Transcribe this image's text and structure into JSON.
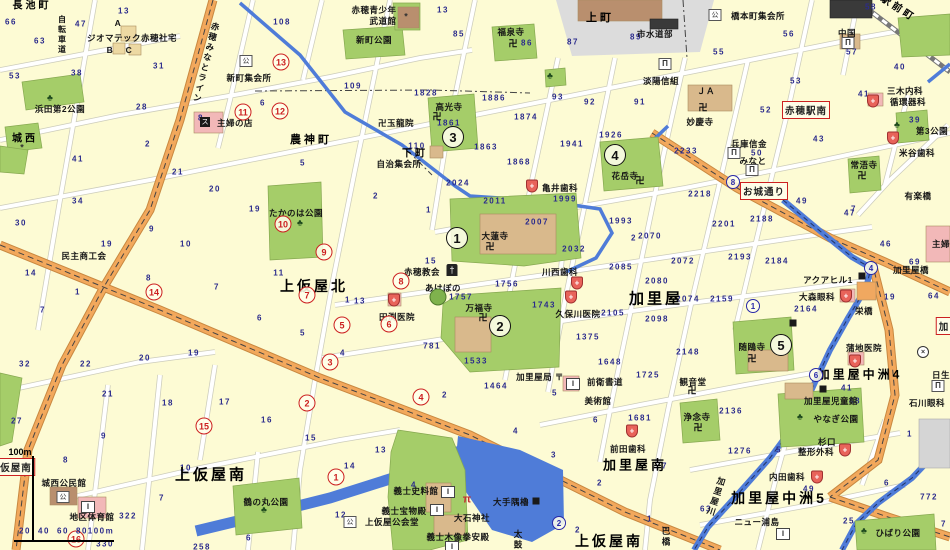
{
  "palette": {
    "background": "#FDFBD4",
    "road": "#FFFFFF",
    "road_casing": "#CCCCBB",
    "main_road": "#F2A85C",
    "water": "#4F7CD8",
    "park": "#A5CD69",
    "building_tan": "#D9B98C",
    "building_brown": "#B98F6E",
    "building_pink": "#F2B8B8",
    "building_gray": "#D5D5D5",
    "building_dark": "#3A3A3A",
    "number_text": "#2B2B8C",
    "red_mark": "#CC2020",
    "blue_mark": "#2828A8"
  },
  "scale": {
    "top_label": "100m",
    "tick_labels": [
      "20",
      "40",
      "60",
      "80",
      "100m"
    ]
  },
  "areas": [
    [
      "長池町",
      32,
      4,
      10,
      0
    ],
    [
      "上町",
      600,
      17,
      11,
      0
    ],
    [
      "駅前町",
      899,
      7,
      10,
      33
    ],
    [
      "農神町",
      311,
      139,
      11,
      0
    ],
    [
      "下町",
      415,
      152,
      10,
      0
    ],
    [
      "城西",
      25,
      137,
      10,
      0
    ],
    [
      "上仮屋北",
      314,
      286,
      14,
      0
    ],
    [
      "加里屋",
      656,
      298,
      15,
      0
    ],
    [
      "上仮屋南",
      211,
      474,
      15,
      0
    ],
    [
      "加里屋南",
      635,
      464,
      13,
      0
    ],
    [
      "上仮屋南",
      609,
      541,
      14,
      0
    ],
    [
      "加里屋中洲4",
      860,
      374,
      12,
      0
    ],
    [
      "加里屋中洲5",
      779,
      498,
      14,
      0
    ]
  ],
  "vlabels": [
    [
      "自転車道",
      62,
      35,
      8,
      0
    ],
    [
      "赤穂みなとライン",
      206,
      63,
      8.5,
      14
    ],
    [
      "加里屋川",
      716,
      497,
      8.5,
      18
    ],
    [
      "巴橋",
      666,
      537,
      8.5,
      0
    ],
    [
      "太鼓",
      518,
      540,
      8.5,
      0
    ]
  ],
  "places": [
    [
      "ジオマテック赤穂社宅",
      132,
      38
    ],
    [
      "A",
      118,
      23
    ],
    [
      "B",
      110,
      50
    ],
    [
      "C",
      129,
      50
    ],
    [
      "新町集会所",
      249,
      78
    ],
    [
      "主婦の店",
      235,
      123
    ],
    [
      "浜田第2公園",
      60,
      109
    ],
    [
      "赤穂青少年",
      374,
      10
    ],
    [
      "武道館",
      383,
      21
    ],
    [
      "新町公園",
      374,
      40
    ],
    [
      "福泉寺",
      511,
      32
    ],
    [
      "卍玉龍院",
      396,
      123
    ],
    [
      "高光寺",
      449,
      107
    ],
    [
      "自治集会所",
      399,
      164
    ],
    [
      "淡陽信組",
      661,
      81
    ],
    [
      "市水道部",
      655,
      34
    ],
    [
      "橋本町集会所",
      758,
      16
    ],
    [
      "中国",
      847,
      33
    ],
    [
      "妙慶寺",
      700,
      122
    ],
    [
      "ＪＡ",
      706,
      91
    ],
    [
      "兵庫信金",
      749,
      144
    ],
    [
      "みなと",
      753,
      161
    ],
    [
      "三木内科",
      905,
      91
    ],
    [
      "循環器科",
      908,
      102
    ],
    [
      "米谷歯科",
      917,
      153
    ],
    [
      "第3公園",
      932,
      131
    ],
    [
      "常浯寺",
      864,
      165
    ],
    [
      "有楽橋",
      918,
      196
    ],
    [
      "加里屋橋",
      911,
      270
    ],
    [
      "栄橋",
      864,
      311
    ],
    [
      "亀井歯科",
      560,
      188
    ],
    [
      "川西歯科",
      560,
      272
    ],
    [
      "久保川医院",
      578,
      314
    ],
    [
      "田渕医院",
      397,
      317
    ],
    [
      "赤穂教会",
      422,
      272
    ],
    [
      "あけぼの",
      443,
      288
    ],
    [
      "大蓮寺",
      495,
      236
    ],
    [
      "万福寺",
      479,
      308
    ],
    [
      "花岳寺",
      625,
      176
    ],
    [
      "たかのは公園",
      296,
      213
    ],
    [
      "民主商工会",
      84,
      256
    ],
    [
      "大森眼科",
      817,
      297
    ],
    [
      "アクアヒル1",
      828,
      280
    ],
    [
      "随鴎寺",
      752,
      347
    ],
    [
      "蒲地医院",
      864,
      348
    ],
    [
      "日生",
      941,
      375
    ],
    [
      "石川眼科",
      927,
      403
    ],
    [
      "観音堂",
      693,
      382
    ],
    [
      "浄念寺",
      697,
      417
    ],
    [
      "加里屋児童館",
      831,
      401
    ],
    [
      "やなぎ公園",
      836,
      419
    ],
    [
      "杉口",
      827,
      442
    ],
    [
      "整形外科",
      816,
      452
    ],
    [
      "内田歯科",
      787,
      477
    ],
    [
      "前田歯科",
      628,
      449
    ],
    [
      "加里屋局 〒",
      540,
      377
    ],
    [
      "前衛書道",
      605,
      382
    ],
    [
      "美術館",
      598,
      401
    ],
    [
      "義士史料館",
      416,
      491
    ],
    [
      "義士宝物殿",
      404,
      511
    ],
    [
      "上仮屋公会堂",
      392,
      522
    ],
    [
      "大石神社",
      472,
      518
    ],
    [
      "大手隅櫓",
      511,
      502
    ],
    [
      "義士木像拳安殿",
      458,
      537
    ],
    [
      "城西公民館",
      64,
      483
    ],
    [
      "地区体育館",
      92,
      517
    ],
    [
      "鶴の丸公園",
      266,
      502
    ],
    [
      "ニュー浦島",
      757,
      522
    ],
    [
      "ひばり公園",
      898,
      533
    ],
    [
      "主婦",
      941,
      244
    ]
  ],
  "numbers": [
    [
      "66",
      11,
      22
    ],
    [
      "63",
      40,
      41
    ],
    [
      "53",
      15,
      76
    ],
    [
      "13",
      124,
      11
    ],
    [
      "47",
      81,
      24
    ],
    [
      "31",
      159,
      66
    ],
    [
      "38",
      77,
      73
    ],
    [
      "28",
      142,
      107
    ],
    [
      "108",
      282,
      22
    ],
    [
      "6",
      263,
      103
    ],
    [
      "8",
      201,
      118
    ],
    [
      "2",
      148,
      144
    ],
    [
      "41",
      78,
      159
    ],
    [
      "21",
      178,
      172
    ],
    [
      "5",
      303,
      163
    ],
    [
      "13",
      443,
      10
    ],
    [
      "85",
      459,
      34
    ],
    [
      "86",
      527,
      43
    ],
    [
      "87",
      573,
      42
    ],
    [
      "109",
      353,
      86
    ],
    [
      "93",
      558,
      97
    ],
    [
      "92",
      590,
      102
    ],
    [
      "1828",
      426,
      93
    ],
    [
      "1886",
      494,
      98
    ],
    [
      "1874",
      526,
      117
    ],
    [
      "1941",
      572,
      144
    ],
    [
      "1926",
      611,
      135
    ],
    [
      "110",
      417,
      146
    ],
    [
      "1863",
      486,
      147
    ],
    [
      "1868",
      519,
      162
    ],
    [
      "1861",
      449,
      123
    ],
    [
      "58",
      871,
      7
    ],
    [
      "89",
      636,
      37
    ],
    [
      "56",
      789,
      34
    ],
    [
      "55",
      719,
      52
    ],
    [
      "53",
      796,
      81
    ],
    [
      "52",
      766,
      110
    ],
    [
      "40",
      900,
      67
    ],
    [
      "57",
      852,
      52
    ],
    [
      "43",
      819,
      139
    ],
    [
      "91",
      640,
      102
    ],
    [
      "2233",
      686,
      151
    ],
    [
      "39",
      915,
      120
    ],
    [
      "41",
      864,
      94
    ],
    [
      "7",
      854,
      209
    ],
    [
      "2024",
      458,
      183
    ],
    [
      "2011",
      495,
      201
    ],
    [
      "1999",
      565,
      199
    ],
    [
      "2007",
      537,
      222
    ],
    [
      "1993",
      621,
      221
    ],
    [
      "2",
      634,
      238
    ],
    [
      "2032",
      574,
      249
    ],
    [
      "2085",
      621,
      267
    ],
    [
      "2",
      376,
      196
    ],
    [
      "1",
      429,
      210
    ],
    [
      "15",
      431,
      261
    ],
    [
      "13",
      360,
      301
    ],
    [
      "4",
      343,
      353
    ],
    [
      "1756",
      507,
      284
    ],
    [
      "1757",
      461,
      297
    ],
    [
      "1743",
      544,
      305
    ],
    [
      "2105",
      613,
      313
    ],
    [
      "1375",
      588,
      337
    ],
    [
      "1533",
      476,
      361
    ],
    [
      "781",
      432,
      346
    ],
    [
      "1648",
      610,
      362
    ],
    [
      "2098",
      657,
      319
    ],
    [
      "2148",
      688,
      352
    ],
    [
      "2080",
      657,
      281
    ],
    [
      "2070",
      650,
      236
    ],
    [
      "2072",
      683,
      261
    ],
    [
      "2201",
      724,
      224
    ],
    [
      "2188",
      762,
      219
    ],
    [
      "2218",
      700,
      194
    ],
    [
      "2193",
      740,
      257
    ],
    [
      "2184",
      777,
      261
    ],
    [
      "2074",
      688,
      299
    ],
    [
      "2159",
      722,
      299
    ],
    [
      "2164",
      806,
      309
    ],
    [
      "49",
      802,
      201
    ],
    [
      "47",
      850,
      213
    ],
    [
      "46",
      886,
      244
    ],
    [
      "69",
      915,
      262
    ],
    [
      "64",
      934,
      296
    ],
    [
      "19",
      890,
      297
    ],
    [
      "50",
      757,
      153
    ],
    [
      "34",
      78,
      201
    ],
    [
      "30",
      21,
      223
    ],
    [
      "19",
      107,
      244
    ],
    [
      "9",
      152,
      229
    ],
    [
      "10",
      186,
      244
    ],
    [
      "20",
      215,
      189
    ],
    [
      "19",
      255,
      209
    ],
    [
      "8",
      149,
      278
    ],
    [
      "7",
      217,
      287
    ],
    [
      "11",
      279,
      273
    ],
    [
      "6",
      260,
      318
    ],
    [
      "5",
      303,
      333
    ],
    [
      "1",
      348,
      300
    ],
    [
      "14",
      31,
      273
    ],
    [
      "1",
      78,
      292
    ],
    [
      "7",
      43,
      310
    ],
    [
      "32",
      25,
      364
    ],
    [
      "22",
      86,
      364
    ],
    [
      "20",
      145,
      358
    ],
    [
      "19",
      194,
      353
    ],
    [
      "27",
      17,
      421
    ],
    [
      "21",
      108,
      394
    ],
    [
      "18",
      168,
      403
    ],
    [
      "17",
      225,
      402
    ],
    [
      "16",
      267,
      420
    ],
    [
      "15",
      311,
      438
    ],
    [
      "9",
      104,
      436
    ],
    [
      "8",
      66,
      460
    ],
    [
      "10",
      186,
      468
    ],
    [
      "7",
      162,
      498
    ],
    [
      "322",
      128,
      516
    ],
    [
      "330",
      105,
      544
    ],
    [
      "258",
      202,
      547
    ],
    [
      "6",
      249,
      538
    ],
    [
      "1464",
      496,
      386
    ],
    [
      "2",
      445,
      395
    ],
    [
      "5",
      555,
      393
    ],
    [
      "6",
      596,
      420
    ],
    [
      "4",
      516,
      431
    ],
    [
      "3",
      554,
      455
    ],
    [
      "13",
      381,
      450
    ],
    [
      "14",
      350,
      466
    ],
    [
      "4",
      414,
      485
    ],
    [
      "12",
      341,
      515
    ],
    [
      "2",
      600,
      483
    ],
    [
      "2",
      578,
      530
    ],
    [
      "1725",
      648,
      375
    ],
    [
      "1681",
      640,
      418
    ],
    [
      "2136",
      731,
      411
    ],
    [
      "1276",
      740,
      451
    ],
    [
      "5",
      779,
      450
    ],
    [
      "7",
      665,
      466
    ],
    [
      "63",
      706,
      509
    ],
    [
      "41",
      847,
      388
    ],
    [
      "48",
      855,
      401
    ],
    [
      "1",
      910,
      434
    ],
    [
      "6",
      887,
      483
    ],
    [
      "772",
      929,
      497
    ],
    [
      "25",
      849,
      521
    ],
    [
      "7",
      944,
      524
    ],
    [
      "1",
      650,
      519
    ],
    [
      "49",
      809,
      489
    ]
  ],
  "circles": {
    "black": [
      [
        "1",
        457,
        238
      ],
      [
        "2",
        500,
        326
      ],
      [
        "3",
        453,
        137
      ],
      [
        "4",
        615,
        155
      ],
      [
        "5",
        781,
        345
      ]
    ],
    "red": [
      [
        "1",
        336,
        477
      ],
      [
        "2",
        307,
        403
      ],
      [
        "3",
        330,
        362
      ],
      [
        "4",
        421,
        397
      ],
      [
        "5",
        342,
        325
      ],
      [
        "6",
        389,
        324
      ],
      [
        "7",
        307,
        295
      ],
      [
        "8",
        401,
        281
      ],
      [
        "9",
        324,
        252
      ],
      [
        "10",
        283,
        224
      ],
      [
        "11",
        243,
        112
      ],
      [
        "12",
        280,
        111
      ],
      [
        "13",
        281,
        62
      ],
      [
        "14",
        154,
        292
      ],
      [
        "15",
        204,
        426
      ],
      [
        "16",
        76,
        539
      ]
    ],
    "blue": [
      [
        "1",
        753,
        306
      ],
      [
        "2",
        559,
        523
      ],
      [
        "4",
        871,
        268
      ],
      [
        "6",
        816,
        375
      ],
      [
        "8",
        733,
        182
      ]
    ]
  },
  "bus_stops": [
    [
      "お城通り",
      764,
      191
    ],
    [
      "赤穂駅南",
      806,
      110
    ],
    [
      "仮屋南",
      16,
      467
    ],
    [
      "加",
      944,
      326
    ]
  ],
  "icon_glyphs": {
    "temple": "卍",
    "hospital": "+",
    "bank": "Π",
    "public": "公",
    "museum": "‖",
    "store": "ス",
    "church": "†",
    "torii": "π",
    "police": "×",
    "kinder": "",
    "park": "♣",
    "mark": "*",
    "block": ""
  },
  "icons": [
    [
      "temple",
      513,
      44
    ],
    [
      "temple",
      437,
      117
    ],
    [
      "temple",
      490,
      247
    ],
    [
      "temple",
      483,
      318
    ],
    [
      "temple",
      703,
      108
    ],
    [
      "temple",
      640,
      181
    ],
    [
      "temple",
      752,
      359
    ],
    [
      "temple",
      698,
      428
    ],
    [
      "temple",
      692,
      391
    ],
    [
      "temple",
      862,
      176
    ],
    [
      "hospital",
      394,
      300
    ],
    [
      "hospital",
      532,
      186
    ],
    [
      "hospital",
      577,
      283
    ],
    [
      "hospital",
      571,
      297
    ],
    [
      "hospital",
      873,
      101
    ],
    [
      "hospital",
      893,
      138
    ],
    [
      "hospital",
      846,
      296
    ],
    [
      "hospital",
      845,
      450
    ],
    [
      "hospital",
      817,
      477
    ],
    [
      "hospital",
      632,
      431
    ],
    [
      "hospital",
      855,
      361
    ],
    [
      "bank",
      665,
      64
    ],
    [
      "bank",
      848,
      43
    ],
    [
      "bank",
      734,
      153
    ],
    [
      "bank",
      752,
      170
    ],
    [
      "bank",
      938,
      386
    ],
    [
      "public",
      715,
      15
    ],
    [
      "public",
      246,
      61
    ],
    [
      "public",
      350,
      522
    ],
    [
      "public",
      63,
      497
    ],
    [
      "museum",
      448,
      492
    ],
    [
      "museum",
      437,
      510
    ],
    [
      "museum",
      573,
      384
    ],
    [
      "museum",
      452,
      547
    ],
    [
      "museum",
      783,
      534
    ],
    [
      "museum",
      88,
      507
    ],
    [
      "store",
      205,
      122
    ],
    [
      "church",
      452,
      270
    ],
    [
      "torii",
      467,
      500
    ],
    [
      "police",
      923,
      352
    ],
    [
      "kinder",
      438,
      297
    ],
    [
      "park",
      50,
      98
    ],
    [
      "park",
      300,
      223
    ],
    [
      "park",
      550,
      76
    ],
    [
      "park",
      264,
      510
    ],
    [
      "park",
      800,
      417
    ],
    [
      "park",
      864,
      531
    ],
    [
      "park",
      897,
      125
    ],
    [
      "mark",
      22,
      148
    ],
    [
      "mark",
      406,
      17
    ],
    [
      "block",
      793,
      323
    ],
    [
      "block",
      536,
      501
    ],
    [
      "block",
      823,
      389
    ],
    [
      "block",
      862,
      276
    ]
  ]
}
